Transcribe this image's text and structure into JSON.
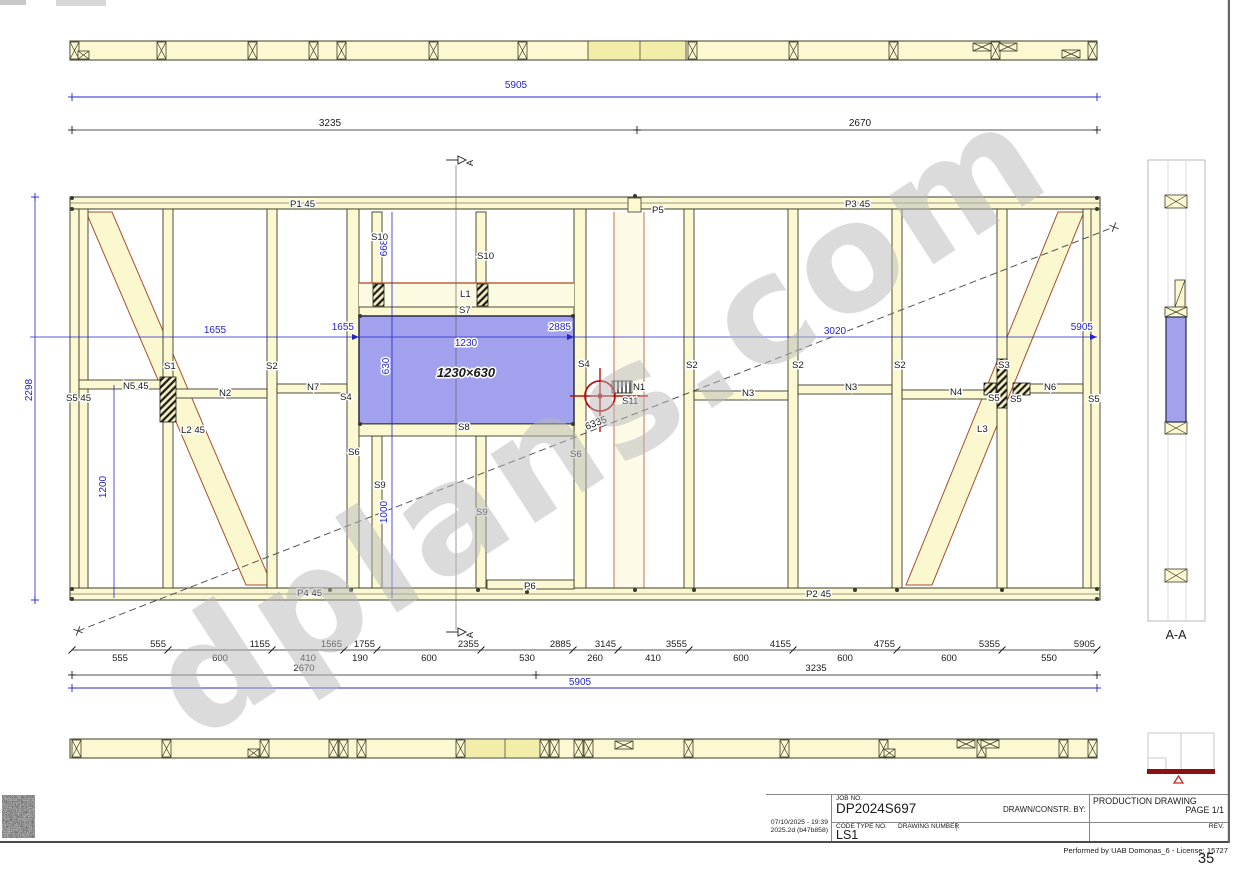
{
  "watermark": "dplans.com",
  "page": {
    "number": "35",
    "performed_by": "Performed by UAB Domonas_6 - License: 15727"
  },
  "title_block": {
    "job_no_label": "JOB NO.",
    "job_no": "DP2024S697",
    "code_type_label": "CODE TYPE NO.",
    "code_type": "LS1",
    "drawing_number_label": "DRAWING NUMBER",
    "drawn_by_label": "DRAWN/CONSTR. BY:",
    "doc_type": "PRODUCTION DRAWING",
    "page_label": "PAGE 1/1",
    "rev_label": "REV.",
    "datetime": "07/10/2025 - 19:39",
    "version": "2025.2d (b47b858)"
  },
  "colors": {
    "wood": "#fbf8d2",
    "wood_hi": "#f3edaa",
    "stroke": "#3c3c28",
    "blue_fill": "#a1a1ee",
    "blue_dim": "#2424cc",
    "brace": "#a8502e",
    "band_edge": "#c06040",
    "red": "#bb1111",
    "keyred": "#8e1111"
  },
  "frame": {
    "strips": [
      {
        "name": "top-plate-strip",
        "x": 70,
        "y": 41,
        "w": 1027,
        "h": 19,
        "xblocks": [
          70,
          157,
          248,
          309,
          337,
          429,
          518,
          688,
          789,
          889,
          991,
          1088
        ],
        "hboxes": [
          [
            973,
            43
          ],
          [
            999,
            43
          ],
          [
            1062,
            50
          ]
        ],
        "small": [
          [
            78,
            51
          ]
        ],
        "highlight": {
          "x": 588,
          "w": 98,
          "div": 640
        }
      },
      {
        "name": "bottom-plate-strip",
        "x": 70,
        "y": 739,
        "w": 1027,
        "h": 19,
        "xblocks": [
          72,
          162,
          260,
          329,
          339,
          357,
          456,
          540,
          550,
          574,
          584,
          684,
          780,
          879,
          977,
          1059,
          1088
        ],
        "hboxes": [
          [
            615,
            741
          ],
          [
            957,
            740
          ],
          [
            981,
            740
          ]
        ],
        "small": [
          [
            248,
            749
          ],
          [
            884,
            749
          ]
        ],
        "highlight": {
          "x": 462,
          "w": 78,
          "div": 505
        }
      }
    ],
    "wall": {
      "left": 70,
      "right": 1100,
      "top": 197,
      "bottom": 600,
      "plate_h": 12
    },
    "studs": [
      [
        70,
        9
      ],
      [
        79,
        9
      ],
      [
        163,
        10
      ],
      [
        267,
        10
      ],
      [
        347,
        12
      ],
      [
        574,
        12
      ],
      [
        684,
        10
      ],
      [
        788,
        10
      ],
      [
        892,
        10
      ],
      [
        997,
        10
      ],
      [
        1083,
        9
      ],
      [
        1091,
        9
      ]
    ],
    "cripples": [
      [
        372,
        212,
        73
      ],
      [
        476,
        212,
        73
      ],
      [
        372,
        436,
        152
      ],
      [
        476,
        436,
        152
      ]
    ],
    "noggins": [
      [
        79,
        380,
        84
      ],
      [
        173,
        389,
        94
      ],
      [
        277,
        384,
        70
      ],
      [
        694,
        391,
        94
      ],
      [
        798,
        385,
        94
      ],
      [
        902,
        390,
        95
      ],
      [
        1027,
        384,
        56
      ]
    ],
    "subplate": [
      487,
      580,
      87,
      9
    ],
    "band": {
      "x": 614,
      "y": 212,
      "w": 30,
      "h": 376
    },
    "p5block": [
      628,
      198,
      13,
      14
    ],
    "window": {
      "x": 359,
      "y": 316,
      "w": 215,
      "h": 108
    },
    "header": {
      "x": 359,
      "y": 283,
      "w": 215,
      "h": 24
    },
    "s7": {
      "x": 359,
      "y": 307,
      "w": 215,
      "h": 9
    },
    "sill": {
      "x": 359,
      "y": 424,
      "w": 215,
      "h": 12
    },
    "braces": [
      [
        86,
        212,
        112,
        212,
        272,
        585,
        246,
        585
      ],
      [
        1058,
        212,
        1084,
        212,
        932,
        585,
        906,
        585
      ]
    ],
    "hatches": [
      [
        160,
        377,
        16,
        45,
        "d"
      ],
      [
        373,
        284,
        11,
        22,
        "d"
      ],
      [
        477,
        284,
        11,
        22,
        "d"
      ],
      [
        997,
        359,
        10,
        49,
        "d"
      ],
      [
        1013,
        383,
        17,
        12,
        "d"
      ],
      [
        984,
        383,
        12,
        12,
        "d"
      ],
      [
        612,
        381,
        20,
        12,
        "v"
      ]
    ],
    "dots": [
      [
        72,
        198
      ],
      [
        72,
        209
      ],
      [
        635,
        196
      ],
      [
        1097,
        198
      ],
      [
        1097,
        209
      ],
      [
        72,
        589
      ],
      [
        72,
        599
      ],
      [
        330,
        590
      ],
      [
        351,
        590
      ],
      [
        478,
        590
      ],
      [
        527,
        592
      ],
      [
        635,
        590
      ],
      [
        694,
        590
      ],
      [
        855,
        590
      ],
      [
        897,
        590
      ],
      [
        1002,
        590
      ],
      [
        1097,
        589
      ],
      [
        1097,
        599
      ],
      [
        360,
        316
      ],
      [
        573,
        316
      ],
      [
        360,
        424
      ],
      [
        573,
        424
      ]
    ],
    "vlines": [
      [
        35,
        197,
        600
      ],
      [
        392,
        212,
        598
      ],
      [
        114,
        385,
        598
      ]
    ],
    "cutline": {
      "x": 456,
      "y1": 165,
      "y2": 630
    },
    "markers": [
      [
        456,
        160
      ],
      [
        456,
        632
      ]
    ],
    "diagonal": {
      "x1": 78,
      "y1": 631,
      "x2": 1114,
      "y2": 227
    },
    "crosshair": {
      "cx": 600,
      "cy": 396,
      "r": 15
    },
    "section": {
      "x": 1148,
      "y": 160,
      "w": 57,
      "h": 461,
      "inner": [
        1168,
        1186
      ],
      "xboxes": [
        [
          1165,
          195,
          22,
          13
        ],
        [
          1165,
          307,
          22,
          10
        ],
        [
          1165,
          422,
          22,
          12
        ],
        [
          1165,
          569,
          22,
          13
        ]
      ],
      "stud": [
        1175,
        280,
        10,
        27
      ],
      "win": [
        1166,
        317,
        20,
        105
      ],
      "label_x": 1176,
      "label_y": 639
    },
    "keyplan": {
      "x": 1148,
      "y": 733,
      "w": 66,
      "h": 38,
      "vline": 1181,
      "hline_y": 758,
      "hline_x2": 1166,
      "bar": [
        1147,
        769,
        68,
        5
      ],
      "tri": "1174,783 1183,783 1178.5,776"
    }
  },
  "annotations": {
    "member_labels": [
      [
        "P1 45",
        290,
        207
      ],
      [
        "P5",
        652,
        213
      ],
      [
        "P3 45",
        845,
        207
      ],
      [
        "P4 45",
        297,
        596
      ],
      [
        "P6",
        524,
        589
      ],
      [
        "P2 45",
        806,
        597
      ],
      [
        "S10",
        371,
        240
      ],
      [
        "S10",
        477,
        259
      ],
      [
        "L1",
        460,
        297
      ],
      [
        "S7",
        459,
        313
      ],
      [
        "S8",
        458,
        430
      ],
      [
        "S1",
        164,
        369
      ],
      [
        "S2",
        266,
        369
      ],
      [
        "S2",
        686,
        368
      ],
      [
        "S2",
        792,
        368
      ],
      [
        "S2",
        894,
        368
      ],
      [
        "S3",
        998,
        368
      ],
      [
        "S4",
        340,
        400
      ],
      [
        "S4",
        578,
        367
      ],
      [
        "S5 45",
        66,
        401
      ],
      [
        "N5 45",
        123,
        389
      ],
      [
        "N2",
        219,
        396
      ],
      [
        "N7",
        307,
        390
      ],
      [
        "N1",
        633,
        390
      ],
      [
        "S11",
        622,
        404
      ],
      [
        "N3",
        742,
        396
      ],
      [
        "N3",
        845,
        390
      ],
      [
        "N4",
        950,
        395
      ],
      [
        "S5",
        988,
        401
      ],
      [
        "S5",
        1010,
        402
      ],
      [
        "S5",
        1088,
        402
      ],
      [
        "N6",
        1044,
        390
      ],
      [
        "S6",
        348,
        455
      ],
      [
        "S6",
        570,
        457
      ],
      [
        "S9",
        374,
        488
      ],
      [
        "S9",
        476,
        515
      ],
      [
        "L2 45",
        181,
        433
      ],
      [
        "L3",
        977,
        432
      ]
    ],
    "window_size": "1230×630",
    "diagonal_dim": "6335",
    "top_dims": {
      "blue": "5905",
      "blue_y": 97,
      "blue_cx": 516,
      "black": [
        [
          "3235",
          330
        ],
        [
          "2670",
          860
        ]
      ],
      "black_ticks": [
        72,
        637,
        1097
      ],
      "black_y": 130
    },
    "mid_dims": {
      "y": 337,
      "labels": [
        [
          "1655",
          215,
          "middle",
          333
        ],
        [
          "1655",
          354,
          "end",
          330
        ],
        [
          "1230",
          466,
          "middle",
          346
        ],
        [
          "2885",
          571,
          "end",
          330
        ],
        [
          "3020",
          835,
          "middle",
          334
        ],
        [
          "5905",
          1093,
          "end",
          330
        ]
      ],
      "arrows": [
        359,
        574,
        1097
      ]
    },
    "vert_dims": [
      [
        "2298",
        32,
        390
      ],
      [
        "1200",
        106,
        487
      ],
      [
        "668",
        387,
        248
      ],
      [
        "630",
        389,
        366
      ],
      [
        "1000",
        387,
        512
      ]
    ],
    "chain": {
      "y": 650,
      "ticks": [
        72,
        168,
        272,
        344,
        377,
        481,
        573,
        618,
        689,
        793,
        897,
        1002,
        1097
      ],
      "cumulative": [
        "555",
        "1155",
        "1565",
        "1755",
        "2355",
        "2885",
        "3145",
        "3555",
        "4155",
        "4755",
        "5355",
        "5905"
      ],
      "segments": [
        [
          "555",
          120
        ],
        [
          "600",
          220
        ],
        [
          "410",
          308
        ],
        [
          "190",
          360
        ],
        [
          "600",
          429
        ],
        [
          "530",
          527
        ],
        [
          "260",
          595
        ],
        [
          "410",
          653
        ],
        [
          "600",
          741
        ],
        [
          "600",
          845
        ],
        [
          "600",
          949
        ],
        [
          "550",
          1049
        ]
      ]
    },
    "chain2": {
      "y": 675,
      "ticks": [
        72,
        536,
        1097
      ],
      "labels": [
        [
          "2670",
          304
        ],
        [
          "3235",
          816
        ]
      ]
    },
    "total": {
      "y": 688,
      "label": "5905",
      "cx": 580
    },
    "section_label": "A-A",
    "marker_letter": "A"
  }
}
